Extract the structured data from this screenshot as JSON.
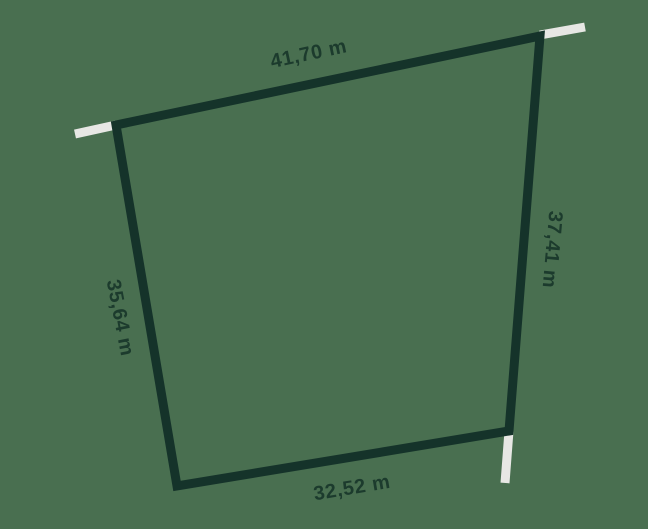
{
  "colors": {
    "background": "#496F50",
    "outline": "#15332A",
    "tick": "#E7E7E4",
    "text": "#1C3B2D"
  },
  "parcel": {
    "outline_points": "116,125 540,36 509,431 177,486",
    "ticks_path": "M116 125 L75 134 M540 35 L585 27 M509 431 L505 483",
    "sides": {
      "top": {
        "label": "41,70 m",
        "transform": "translate(310 60) rotate(-12)"
      },
      "right": {
        "label": "37,41 m",
        "transform": "translate(546 249) rotate(95)"
      },
      "bottom": {
        "label": "32,52 m",
        "transform": "translate(353 494) rotate(-9.5)"
      },
      "left": {
        "label": "35,64 m",
        "transform": "translate(114 319) rotate(79)"
      }
    }
  }
}
